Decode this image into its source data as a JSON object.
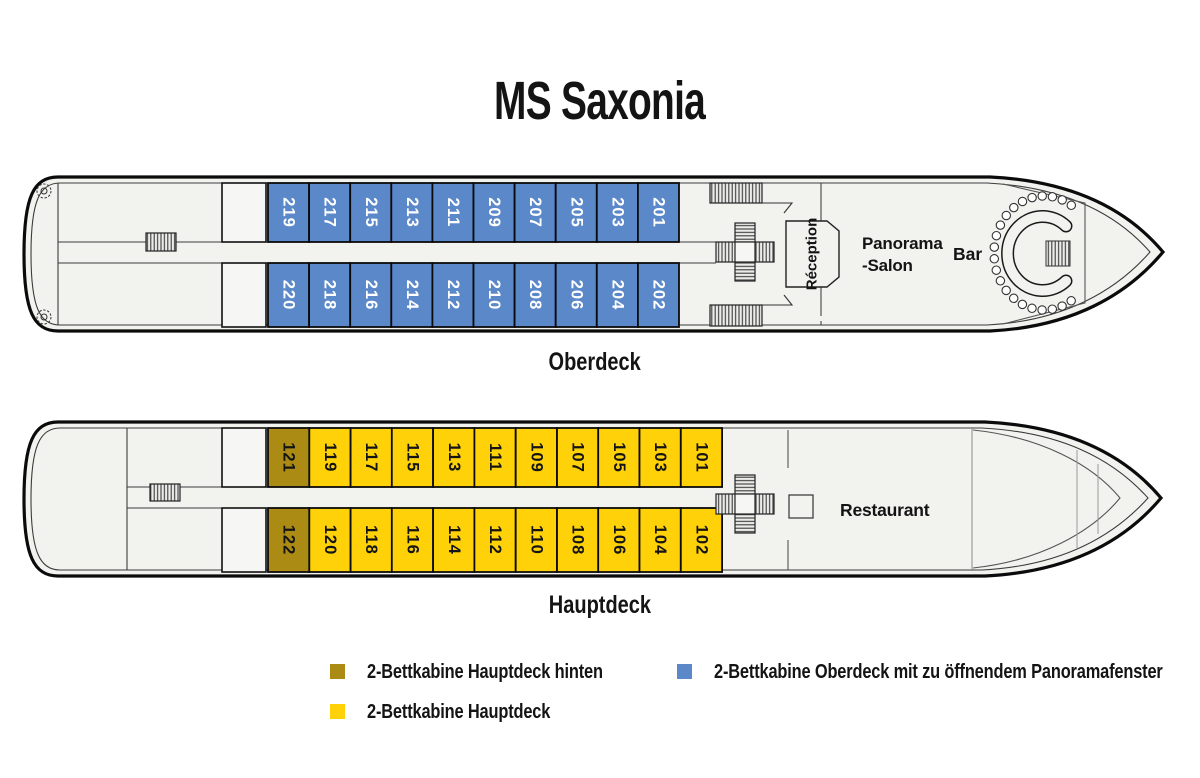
{
  "title": "MS Saxonia",
  "colors": {
    "oberdeck_cabin": "#5b88c9",
    "hauptdeck_cabin": "#fed108",
    "hauptdeck_hinten_cabin": "#ab8b14",
    "cabin_text_oberdeck": "#ffffff",
    "cabin_text_hauptdeck": "#141414",
    "hull_fill": "#f2f2ef",
    "outline": "#0b0b0b"
  },
  "decks": [
    {
      "id": "oberdeck",
      "label": "Oberdeck",
      "row_top": [
        "219",
        "217",
        "215",
        "213",
        "211",
        "209",
        "207",
        "205",
        "203",
        "201"
      ],
      "row_bottom": [
        "220",
        "218",
        "216",
        "214",
        "212",
        "210",
        "208",
        "206",
        "204",
        "202"
      ],
      "rooms": {
        "reception": "Réception",
        "panorama_line1": "Panorama",
        "panorama_line2": "-Salon",
        "bar": "Bar"
      }
    },
    {
      "id": "hauptdeck",
      "label": "Hauptdeck",
      "row_top": [
        "121",
        "119",
        "117",
        "115",
        "113",
        "111",
        "109",
        "107",
        "105",
        "103",
        "101"
      ],
      "row_bottom": [
        "122",
        "120",
        "118",
        "116",
        "114",
        "112",
        "110",
        "108",
        "106",
        "104",
        "102"
      ],
      "hinten_cabins": [
        "121",
        "122"
      ],
      "rooms": {
        "restaurant": "Restaurant"
      }
    }
  ],
  "legend": {
    "items": [
      {
        "label": "2-Bettkabine Hauptdeck hinten",
        "color": "#ab8b14"
      },
      {
        "label": "2-Bettkabine Hauptdeck",
        "color": "#fed108"
      },
      {
        "label": "2-Bettkabine Oberdeck mit zu öffnendem Panoramafenster",
        "color": "#5b88c9"
      }
    ]
  }
}
